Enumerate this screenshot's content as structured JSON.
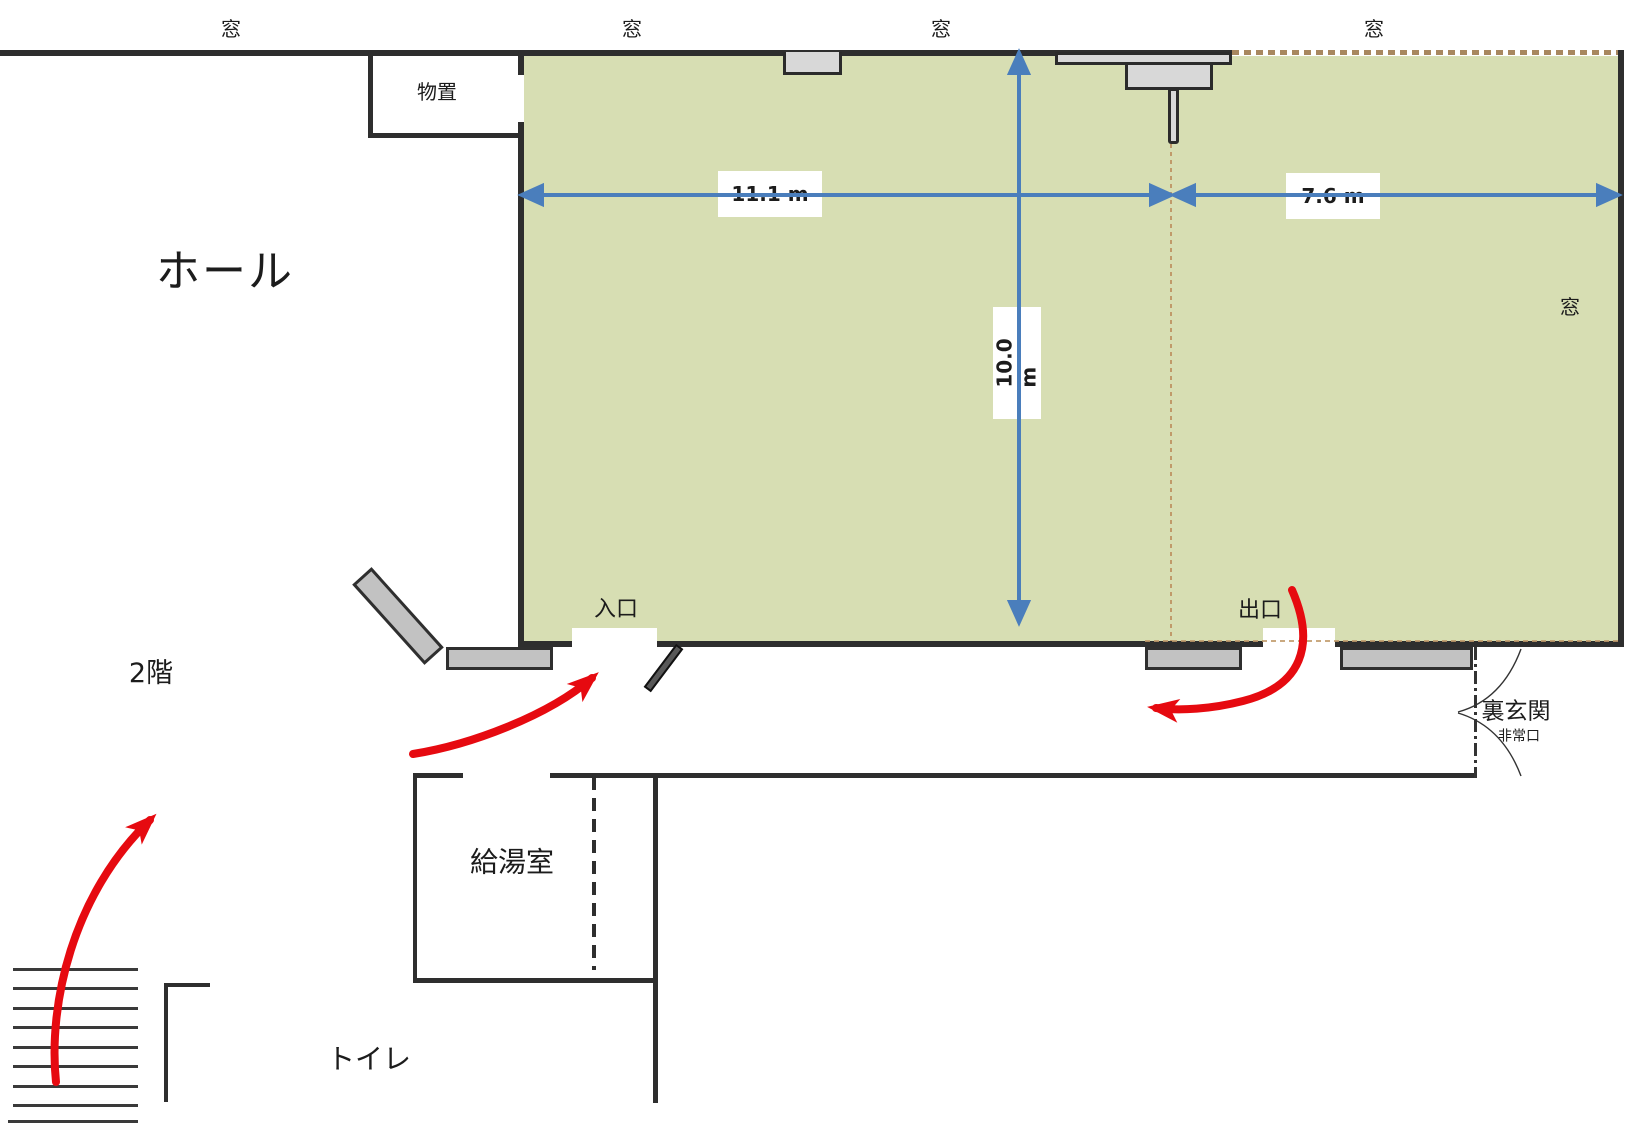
{
  "plan": {
    "hall_label": "ホール",
    "floor_label": "2階",
    "storage_label": "物置",
    "entrance_label": "入口",
    "exit_label": "出口",
    "back_entrance_label": "裏玄関",
    "emergency_exit_label": "非常口",
    "kitchenette_label": "給湯室",
    "toilet_label": "トイレ"
  },
  "windows": {
    "top1": "窓",
    "top2": "窓",
    "top3": "窓",
    "top4": "窓",
    "right": "窓"
  },
  "dimensions": {
    "hall_width_left": "11.1 m",
    "hall_width_right": "7.6 m",
    "hall_depth": "10.0 m"
  },
  "colors": {
    "room_fill": "#d7deb3",
    "wall": "#2e2e2e",
    "dimension_blue": "#4a7ebc",
    "flow_red": "#e60a10",
    "furniture_gray": "#c2c2c2",
    "guide_tan": "#c09a6a"
  }
}
